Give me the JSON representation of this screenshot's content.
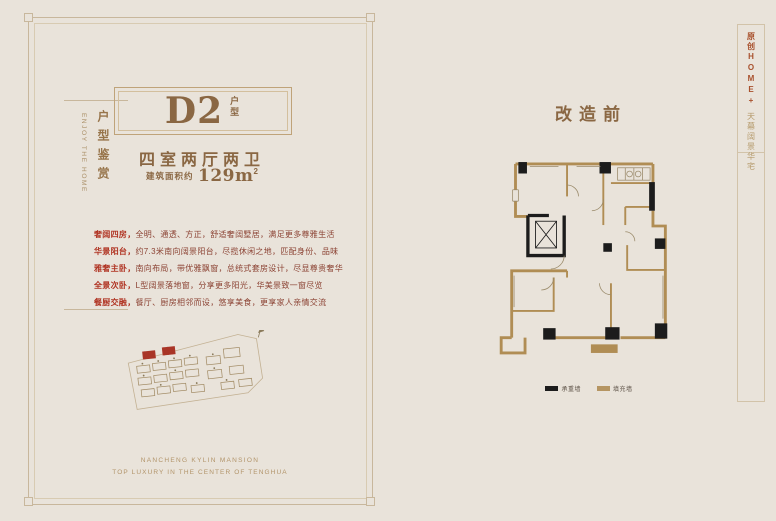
{
  "colors": {
    "background": "#e9e3da",
    "frame_line": "#c8b79c",
    "brand_brown": "#8a6743",
    "feature_red": "#b03322",
    "feature_text": "#8c4334",
    "wall_tan": "#b08d54",
    "wall_black": "#1c1c1c",
    "strip_red": "#a8502c",
    "strip_tan": "#b59a6b"
  },
  "left_panel": {
    "sidebar": {
      "title_cn": "户型鉴赏",
      "title_en": "ENJOY THE HOME"
    },
    "unit": {
      "code": "D2",
      "suffix": "户型"
    },
    "layout_desc": "四室两厅两卫",
    "area_prefix": "建筑面积约",
    "area_number": "129m",
    "area_sup": "2",
    "features": [
      {
        "label": "奢阔四房，",
        "text": "全明、通透、方正，舒适奢阔墅居，满足更多尊雅生活"
      },
      {
        "label": "华景阳台，",
        "text": "约7.3米南向阔景阳台，尽揽休闲之地，匹配身份、品味"
      },
      {
        "label": "雅奢主卧，",
        "text": "南向布局，带优雅飘窗，总统式套房设计，尽显尊贵奢华"
      },
      {
        "label": "全景次卧，",
        "text": "L型阔景落地窗，分享更多阳光，华美景致一窗尽览"
      },
      {
        "label": "餐厨交融，",
        "text": "餐厅、厨房相邻而设，悠享美食，更享家人亲情交流"
      }
    ],
    "footer_en_1": "NANCHENG KYLIN MANSION",
    "footer_en_2": "TOP LUXURY IN THE CENTER OF TENGHUA"
  },
  "right_panel": {
    "title": "改造前",
    "legend": [
      {
        "label": "承重墙",
        "color": "#1c1c1c"
      },
      {
        "label": "填充墙",
        "color": "#b59562"
      }
    ]
  },
  "right_strip": {
    "line1": "原创HOME+",
    "line2": "天幕阔景华宅"
  }
}
